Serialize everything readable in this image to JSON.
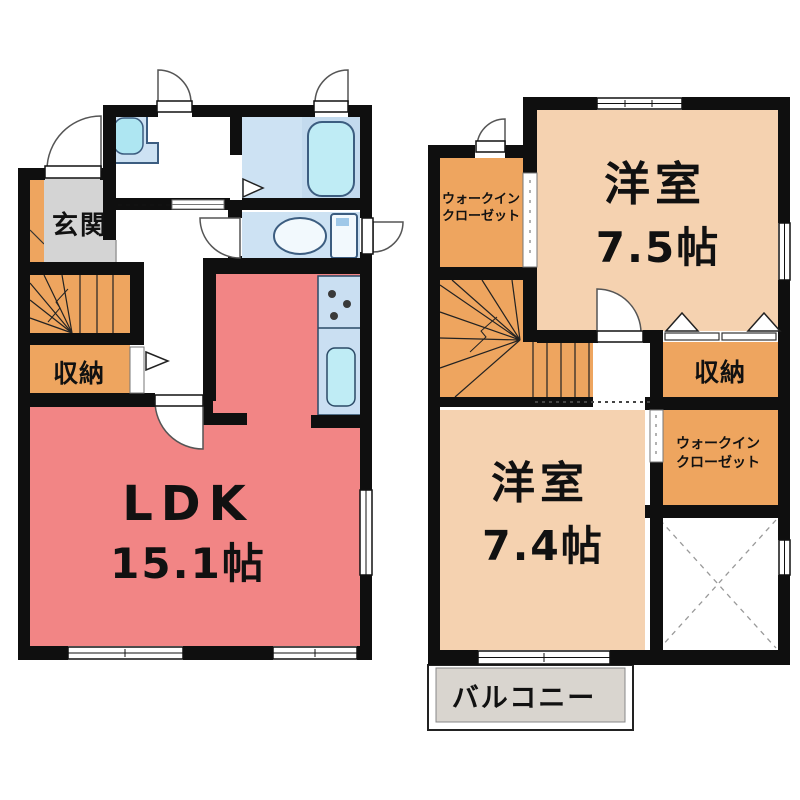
{
  "floor1": {
    "entrance_label": "玄関",
    "storage_label": "収納",
    "ldk_label": "LDK",
    "ldk_area": "15.1帖"
  },
  "floor2": {
    "room_top_label": "洋室",
    "room_top_area": "7.5帖",
    "room_bottom_label": "洋室",
    "room_bottom_area": "7.4帖",
    "wic_top_line1": "ウォークイン",
    "wic_top_line2": "クローゼット",
    "wic_right_line1": "ウォークイン",
    "wic_right_line2": "クローゼット",
    "storage_label": "収納",
    "balcony_label": "バルコニー"
  },
  "palette": {
    "wall": "#0f0f0f",
    "ldk_pink": "#f28585",
    "room_peach": "#f5d2b0",
    "accent_orange": "#eea55f",
    "entrance_gray": "#d4d4d4",
    "balcony_gray": "#d9d5cf",
    "water_blue": "#cde2f3",
    "tub_zone_blue": "#c3daee",
    "fixture_cyan": "#bfecf5"
  }
}
